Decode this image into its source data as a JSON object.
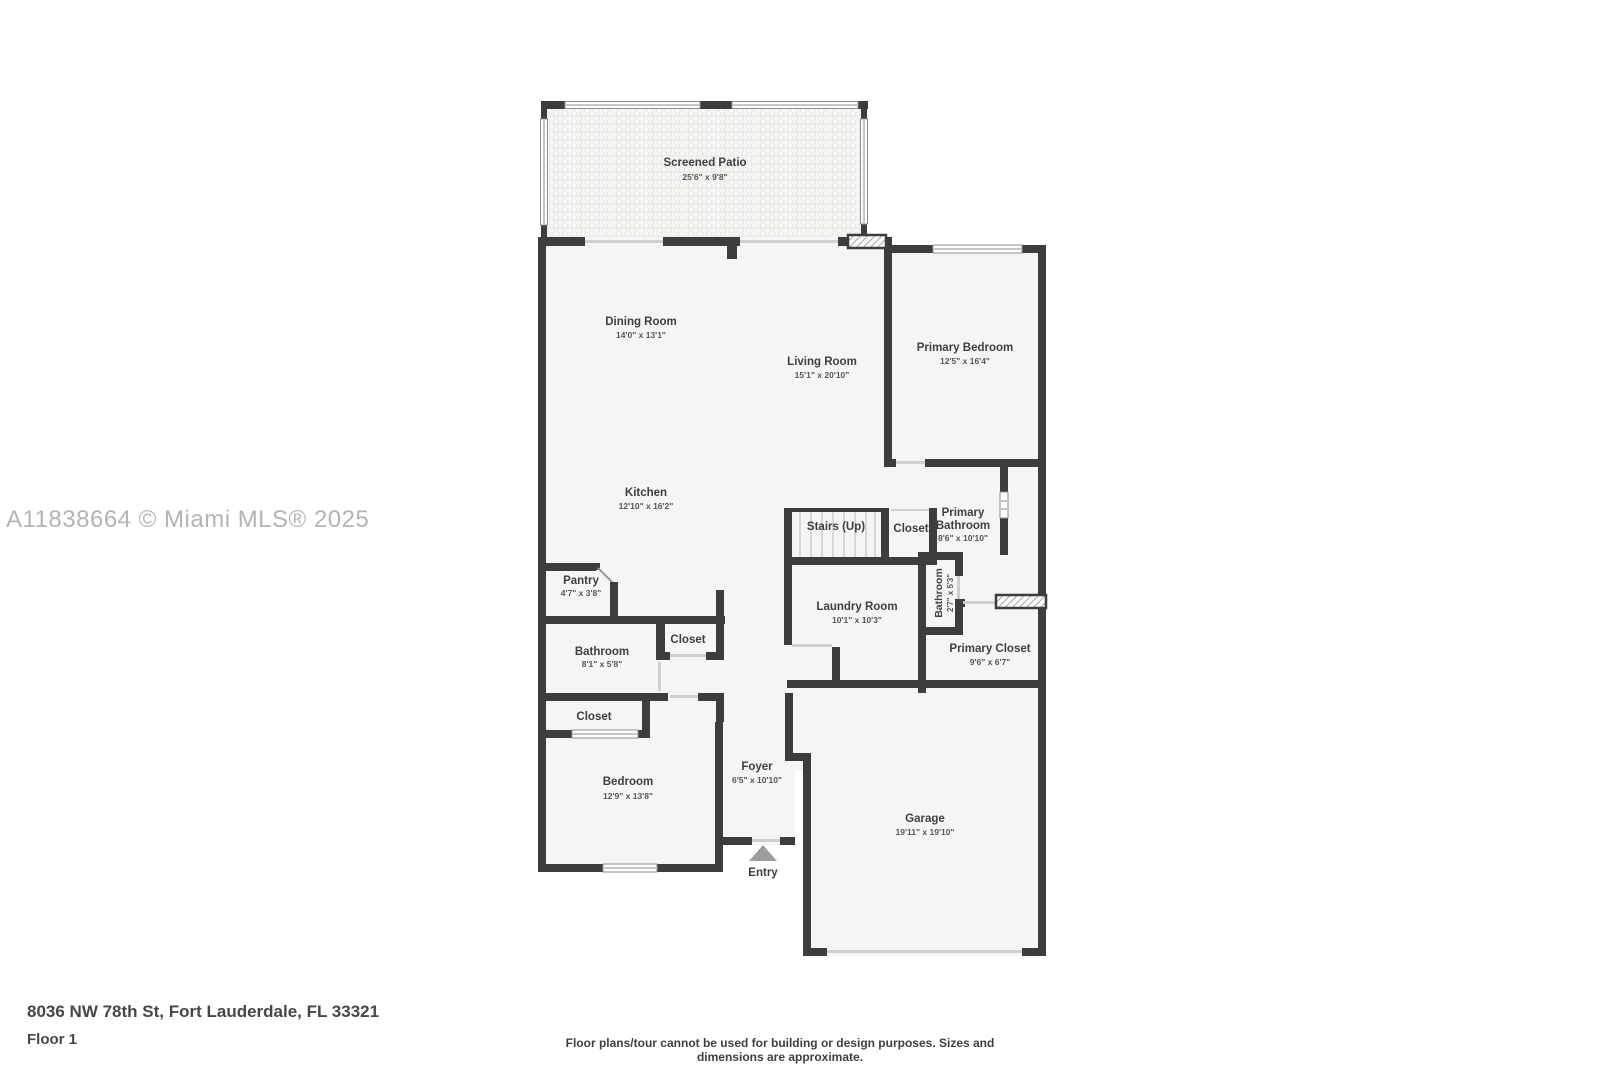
{
  "watermark": "A11838664 © Miami MLS® 2025",
  "footer": {
    "address": "8036 NW 78th St, Fort Lauderdale, FL 33321",
    "floor": "Floor 1",
    "disclaimer": "Floor plans/tour cannot be used for building or design purposes. Sizes and dimensions are approximate."
  },
  "colors": {
    "wall": "#3d3d3d",
    "room_fill": "#f5f5f4",
    "watermark": "#b4b4b4",
    "accent_text": "#3f3f3f"
  },
  "rooms": {
    "screened_patio": {
      "name": "Screened Patio",
      "dims": "25'6\" x 9'8\""
    },
    "dining_room": {
      "name": "Dining Room",
      "dims": "14'0\" x 13'1\""
    },
    "living_room": {
      "name": "Living Room",
      "dims": "15'1\" x 20'10\""
    },
    "primary_bedroom": {
      "name": "Primary Bedroom",
      "dims": "12'5\" x 16'4\""
    },
    "kitchen": {
      "name": "Kitchen",
      "dims": "12'10\" x 16'2\""
    },
    "stairs": {
      "name": "Stairs (Up)"
    },
    "stair_closet": {
      "name": "Closet"
    },
    "primary_bathroom": {
      "name_line1": "Primary",
      "name_line2": "Bathroom",
      "dims": "8'6\" x 10'10\""
    },
    "pantry": {
      "name": "Pantry",
      "dims": "4'7\" x 3'8\""
    },
    "laundry_room": {
      "name": "Laundry Room",
      "dims": "10'1\" x 10'3\""
    },
    "small_bathroom": {
      "name": "Bathroom",
      "dims": "2'7\" x 5'3\""
    },
    "primary_closet": {
      "name": "Primary Closet",
      "dims": "9'6\" x 6'7\""
    },
    "bathroom": {
      "name": "Bathroom",
      "dims": "8'1\" x 5'8\""
    },
    "hall_closet": {
      "name": "Closet"
    },
    "bedroom_closet": {
      "name": "Closet"
    },
    "bedroom": {
      "name": "Bedroom",
      "dims": "12'9\" x 13'8\""
    },
    "foyer": {
      "name": "Foyer",
      "dims": "6'5\" x 10'10\""
    },
    "garage": {
      "name": "Garage",
      "dims": "19'11\" x 19'10\""
    },
    "entry": {
      "name": "Entry"
    }
  }
}
